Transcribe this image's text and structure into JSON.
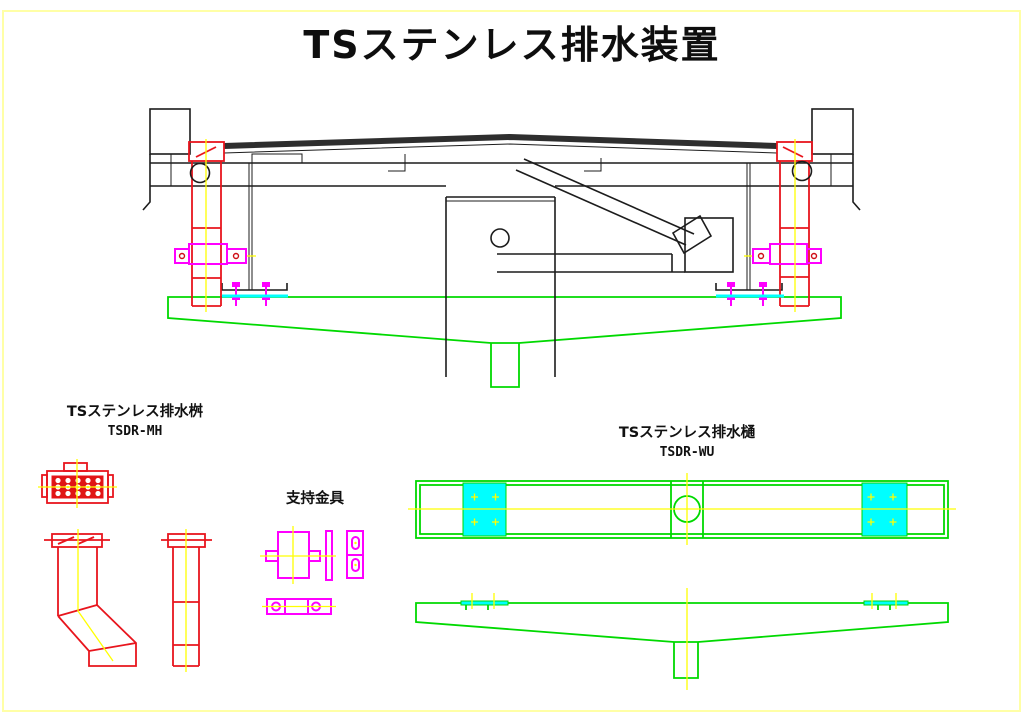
{
  "page": {
    "title": "TSステンレス排水装置"
  },
  "views": {
    "drain_box": {
      "title": "TSステンレス排水桝",
      "model": "TSDR-MH"
    },
    "support_bracket": {
      "title": "支持金具"
    },
    "drain_gutter": {
      "title": "TSステンレス排水樋",
      "model": "TSDR-WU"
    }
  },
  "colors": {
    "pipe_red": "#e8151d",
    "bracket_magenta": "#ff00ff",
    "gutter_green": "#00d900",
    "gasket_cyan": "#00ffff",
    "centerline_yellow": "#ffff00",
    "structure_black": "#1c1c1c",
    "page_border_yellow": "#ffffa6"
  }
}
